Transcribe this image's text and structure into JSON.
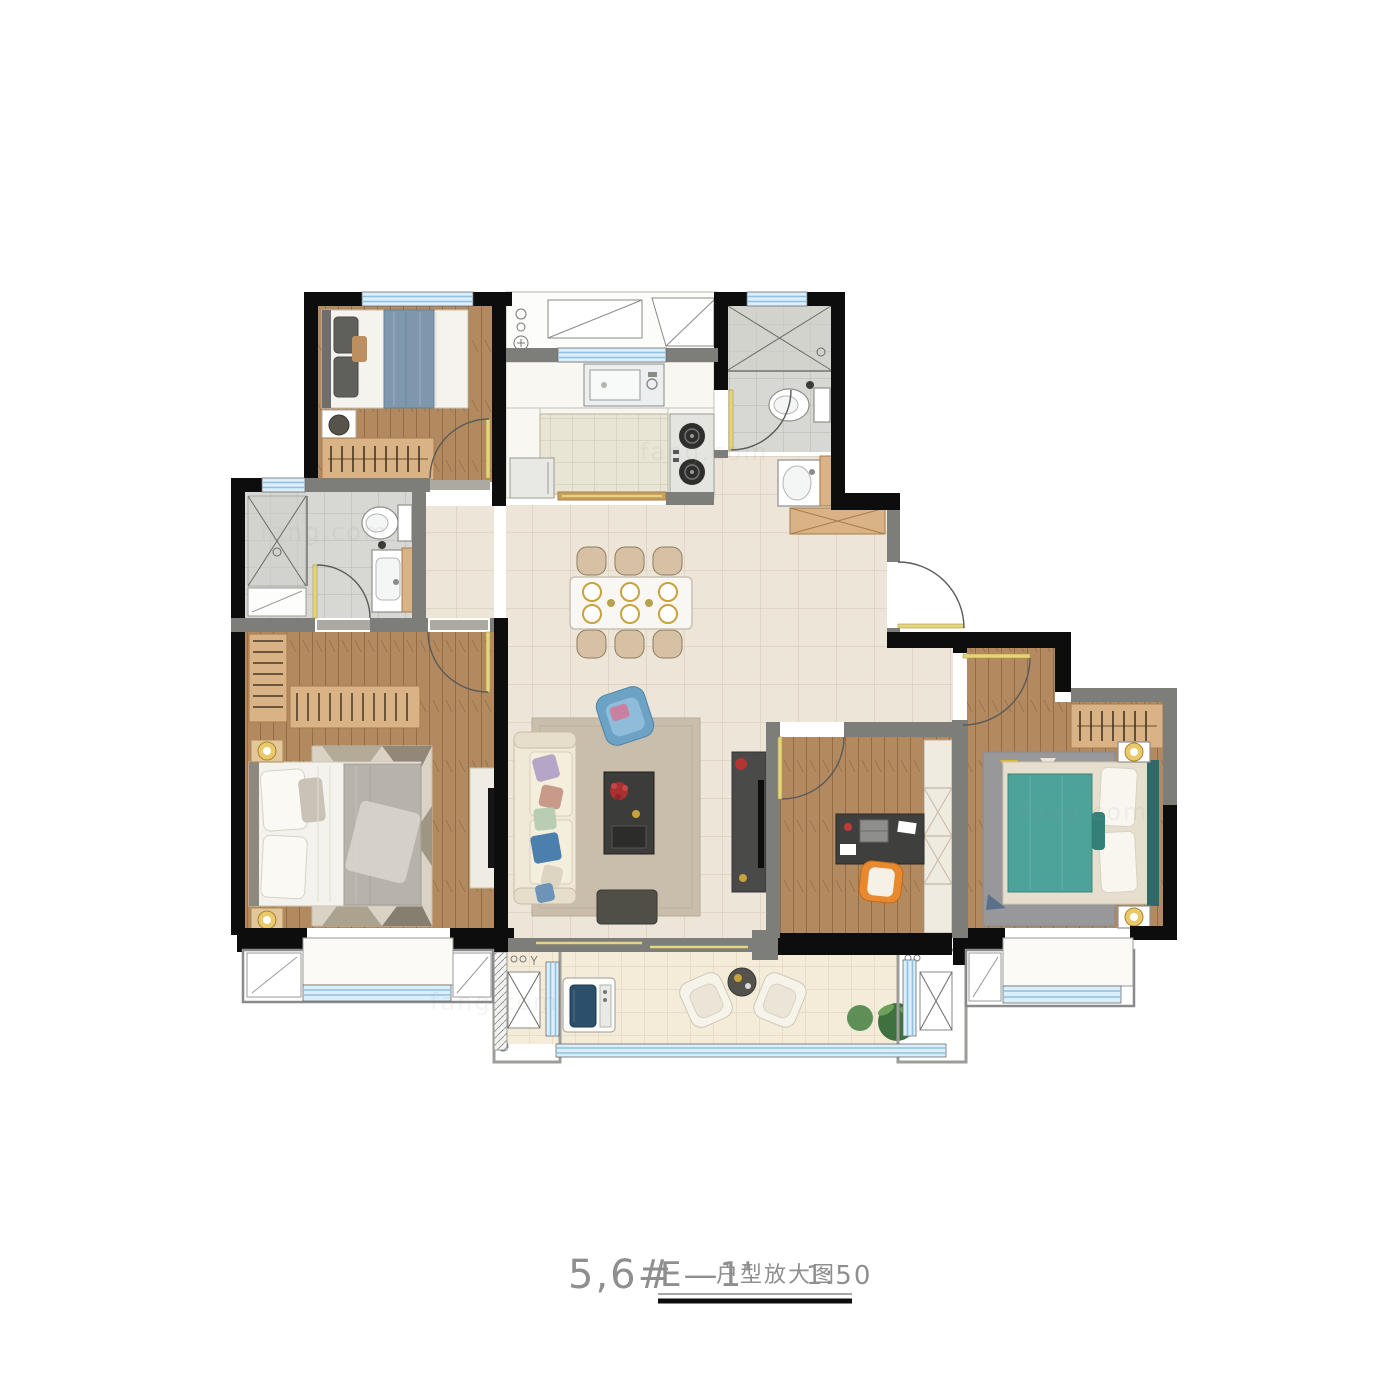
{
  "title_block": {
    "building_no": "5,6#",
    "unit_code": "E—1'",
    "label": "户型放大图",
    "scale": "1:50"
  },
  "watermark": "fang.com",
  "colors": {
    "wall": "#0d0d0d",
    "partition": "#7d7d7a",
    "trim": "#9c9c99",
    "window_fill": "#daeefb",
    "window_line": "#8fc0e0",
    "door": "#e6d57c",
    "arc": "#5a5a5a",
    "wood": "#b38a5f",
    "cabinet": "#d9b285",
    "cabinet_edge": "#a87c4c",
    "counter": "#f8f7f2",
    "sofa": "#f0e9d8",
    "rug": "#c9bdab",
    "teal": "#4da29a",
    "teal_dark": "#2f6b66",
    "steel_blue": "#7e97ac",
    "orange": "#e8882f",
    "dark_furniture": "#3c3c3a",
    "red": "#b23434",
    "gold": "#c9a23c",
    "text": "#8f8f8f"
  }
}
